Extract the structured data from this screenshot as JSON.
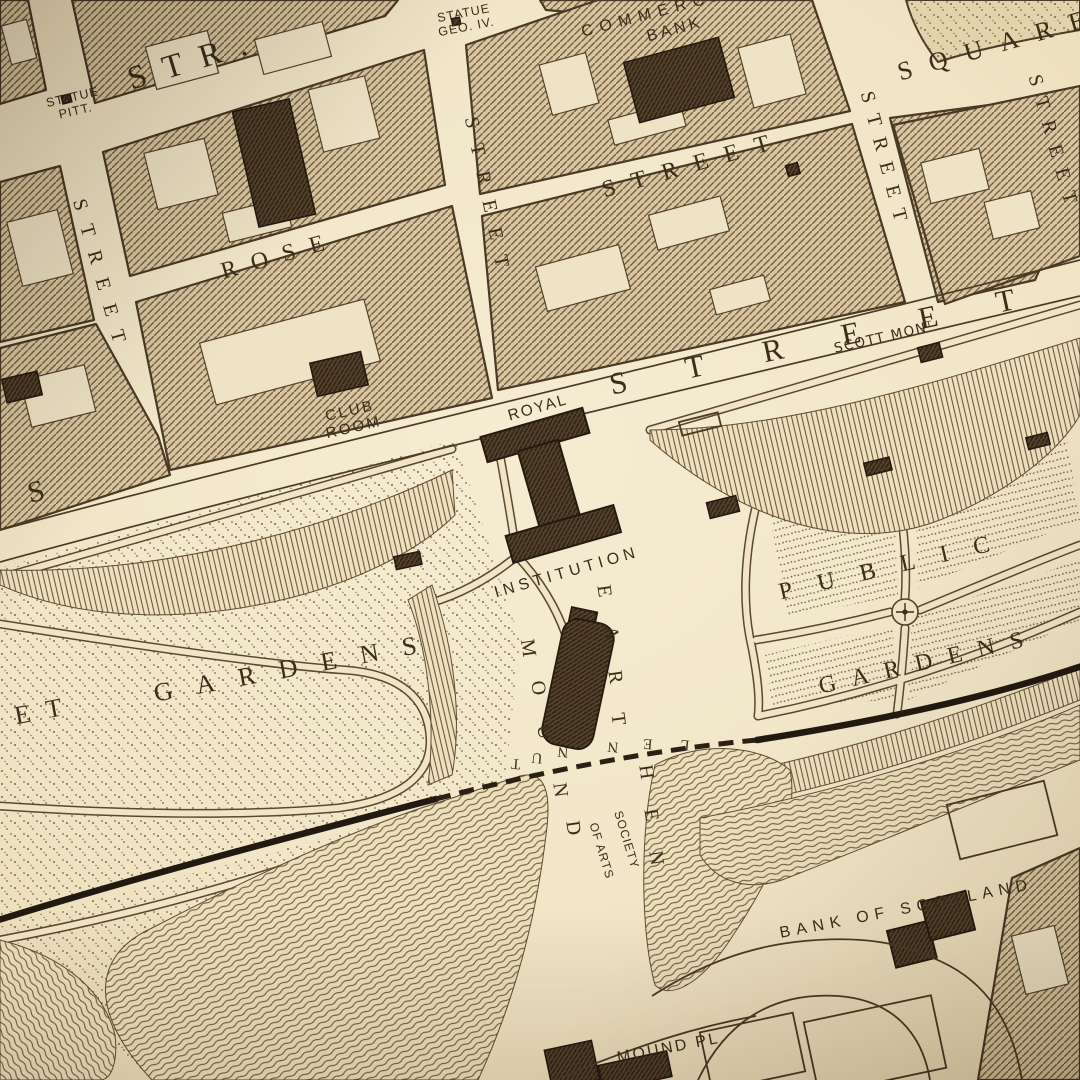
{
  "map": {
    "colors": {
      "paper": "#f1e5c6",
      "ink": "#3a2d1b",
      "block_fill": "#d7c6a1",
      "dark_building": "#55422c",
      "railway": "#221910"
    },
    "labels": {
      "george_str": "STR.",
      "statue_pitt": [
        "STATUE",
        "PITT."
      ],
      "statue_geo": [
        "STATUE",
        "GEO. IV."
      ],
      "commercial": "COMMERCIAL",
      "bank": "BANK",
      "square": "SQUARE",
      "rose": "ROSE",
      "rose_street": "STREET",
      "frederick_street": "STREET",
      "hanover_street": "STREET",
      "stdavid_street": "STREET",
      "farright_street": "STREET",
      "princes_s": "S",
      "princes_street": "STREET",
      "scott_mont": "SCOTT MONᵀ",
      "club_room": [
        "CLUB",
        "ROOM"
      ],
      "royal": "ROYAL",
      "institution": "INSTITUTION",
      "society": "SOCIETY",
      "of_arts": "OF ARTS",
      "gardens_et": "ET",
      "gardens_left": "GARDENS",
      "public": "PUBLIC",
      "gardens_right": "GARDENS",
      "bank_scotland": "BANK OF SCOTLAND",
      "mound_pl": "MOUND PL."
    },
    "letters": {
      "earthen": [
        "E",
        "A",
        "R",
        "T",
        "H",
        "E",
        "N"
      ],
      "mound": [
        "M",
        "O",
        "U",
        "N",
        "D"
      ],
      "tunnel": [
        "T",
        "U",
        "N",
        "N",
        "E",
        "L"
      ]
    }
  }
}
